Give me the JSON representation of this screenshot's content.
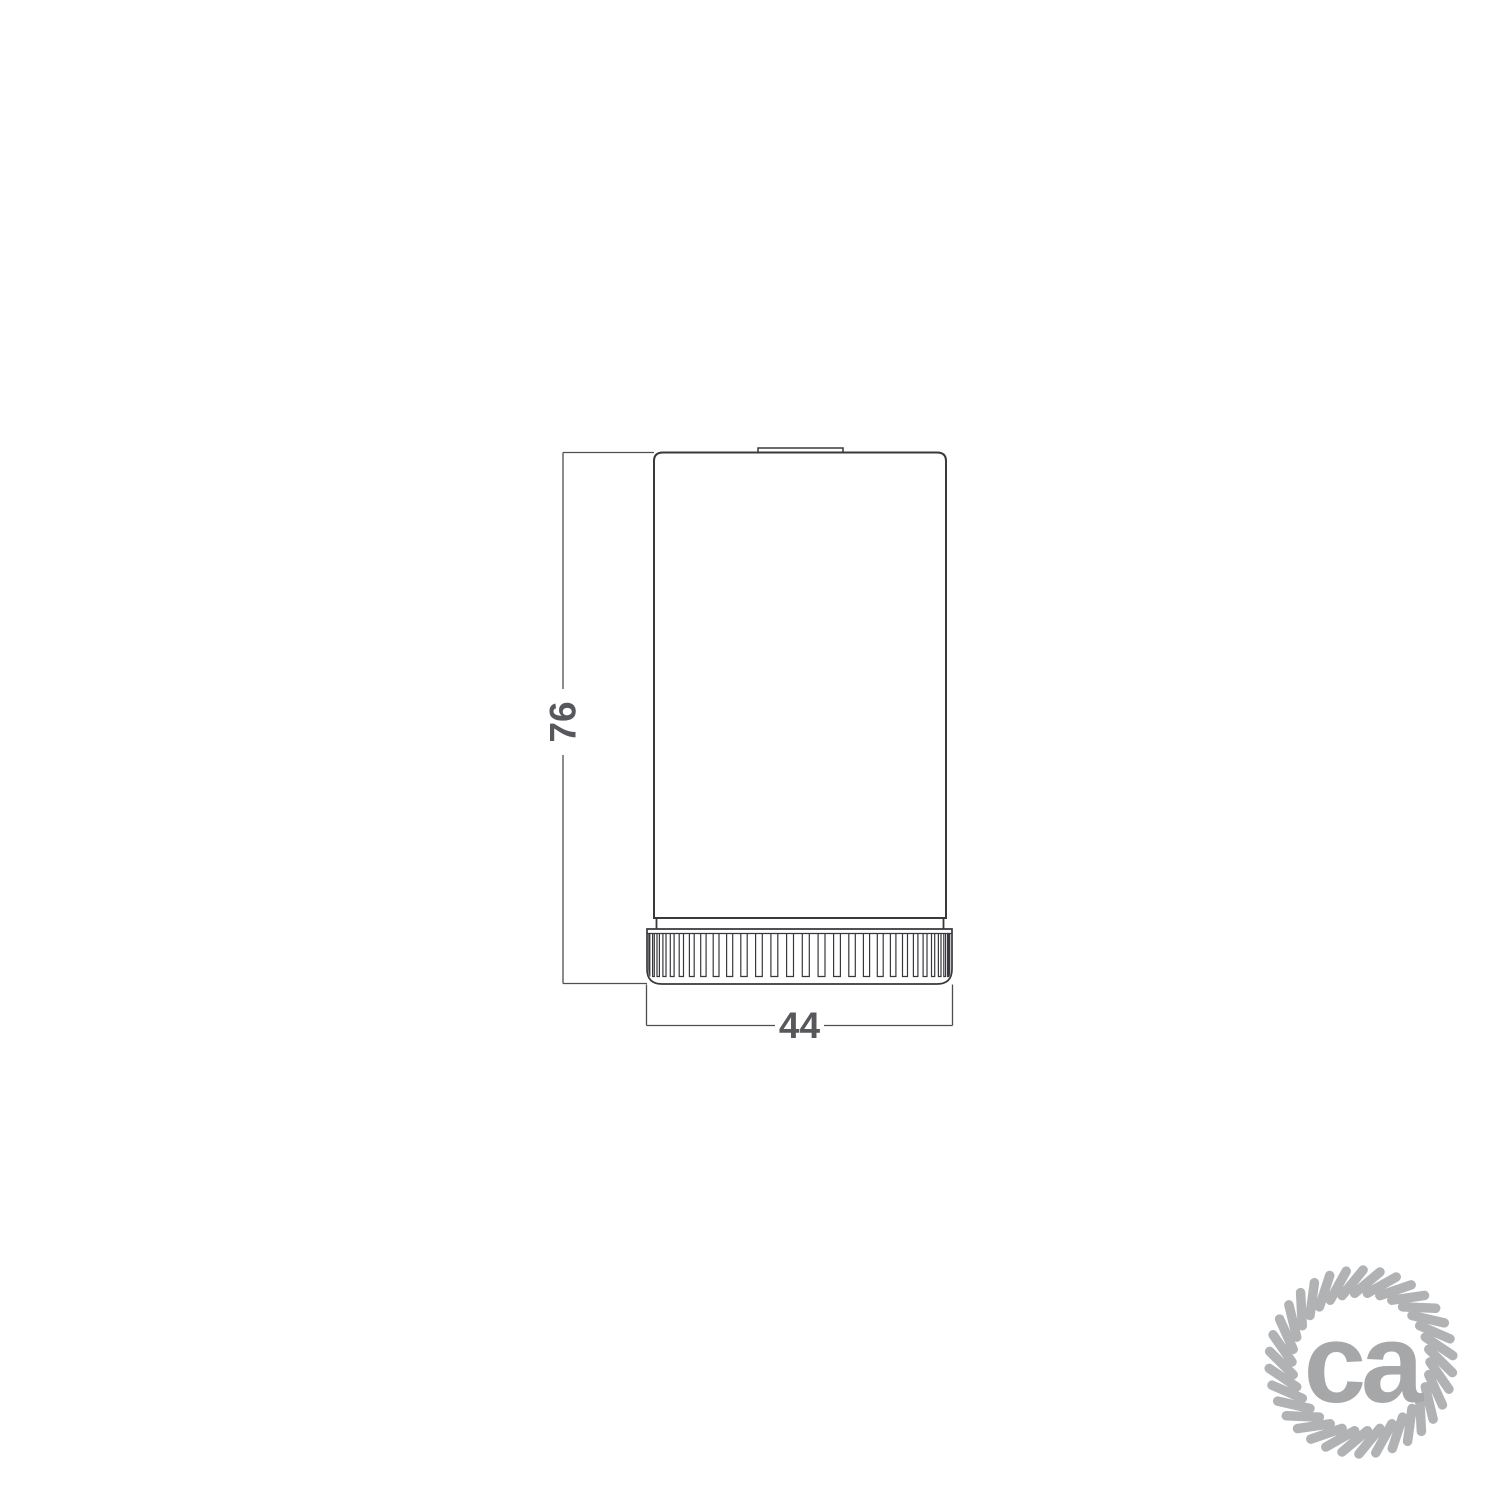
{
  "drawing": {
    "type": "technical-dimension-drawing",
    "subject": "cylindrical lamp holder with knurled ring, front view",
    "dimensions": {
      "height_label": "76",
      "width_label": "44"
    }
  },
  "logo": {
    "text": "ca"
  },
  "colors": {
    "outline": "#38393c",
    "dimension_line": "#4e4f53",
    "dimension_text": "#57585c",
    "logo_rope": "#b1b2b4",
    "logo_text": "#a6a7a9",
    "background": "#ffffff"
  }
}
